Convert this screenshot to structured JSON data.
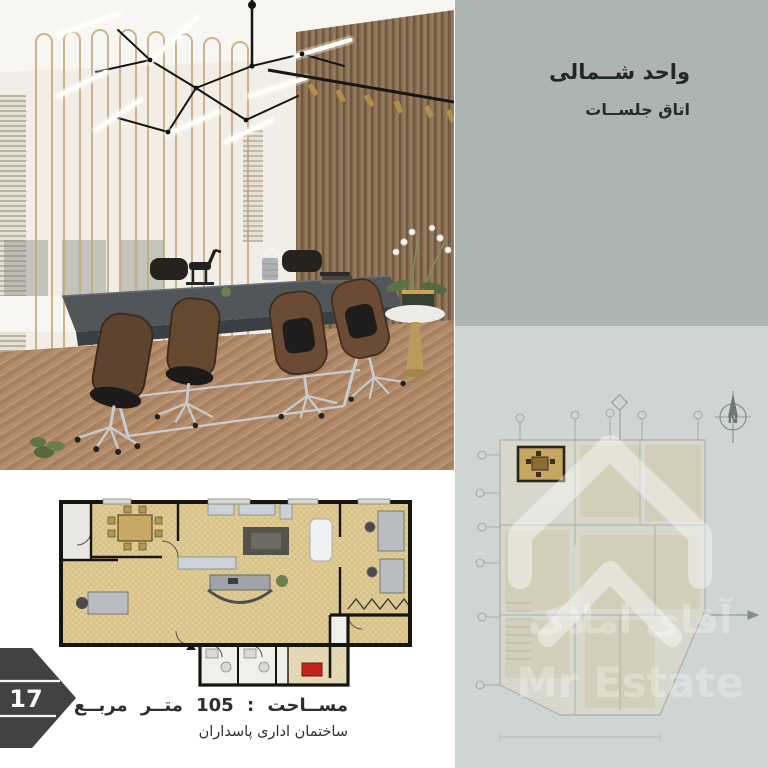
{
  "header": {
    "title": "واحد شــمالی",
    "subtitle": "اتاق جلســات"
  },
  "footer": {
    "area_label": "مســاحت : 105 متــر مربــع",
    "building_label": "ساختمان اداری پاسداران"
  },
  "page_badge": {
    "number": "17"
  },
  "watermark": {
    "name_fa": "آقای املاک",
    "name_en": "Mr Estate"
  },
  "compass": {
    "north_label": "N"
  },
  "colors": {
    "panel_top": "#adb5b1",
    "panel_bottom": "#cfd5d3",
    "plan_floor_beige": "#e0cc96",
    "plan_wall_dark": "#17150f",
    "highlight_room": "#c6a55e",
    "stove_red": "#c0261d",
    "badge_gray": "#424242",
    "text_dark": "#2e2e2e",
    "wood_slat": "#8d7355",
    "photo_floor": "#b18a69",
    "gold_accent": "#c5a87d"
  }
}
